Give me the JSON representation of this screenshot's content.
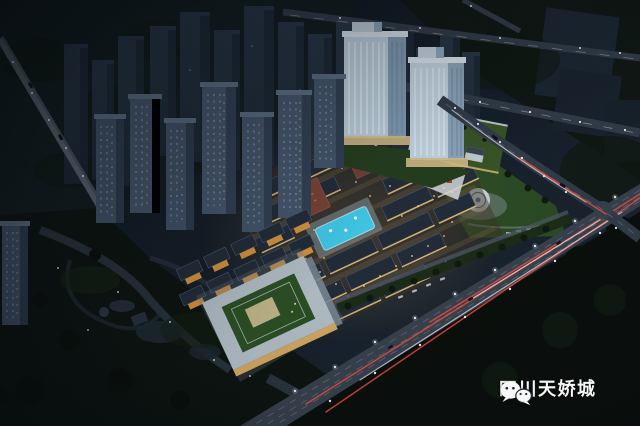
{
  "watermark": {
    "icon": "wechat-logo",
    "text": "四川天娇城",
    "text_color": "#ffffff"
  },
  "scene": {
    "type": "aerial-night-rendering-of-real-estate-development",
    "colors": {
      "sky_top": "#0e151d",
      "sky_bottom": "#1d2833",
      "pool": "#41cdec",
      "warm_light": "#f2c67f",
      "lawn": "#2d4c25",
      "podium_lawn": "#3a5628",
      "road": "#39434f",
      "tail_light_trail": "#ff5044",
      "headlight_trail": "#ffffff",
      "lit_tower_facade": "#c0d4e3",
      "brick_building": "#7c4338",
      "dark_park": "#0d1410"
    }
  }
}
